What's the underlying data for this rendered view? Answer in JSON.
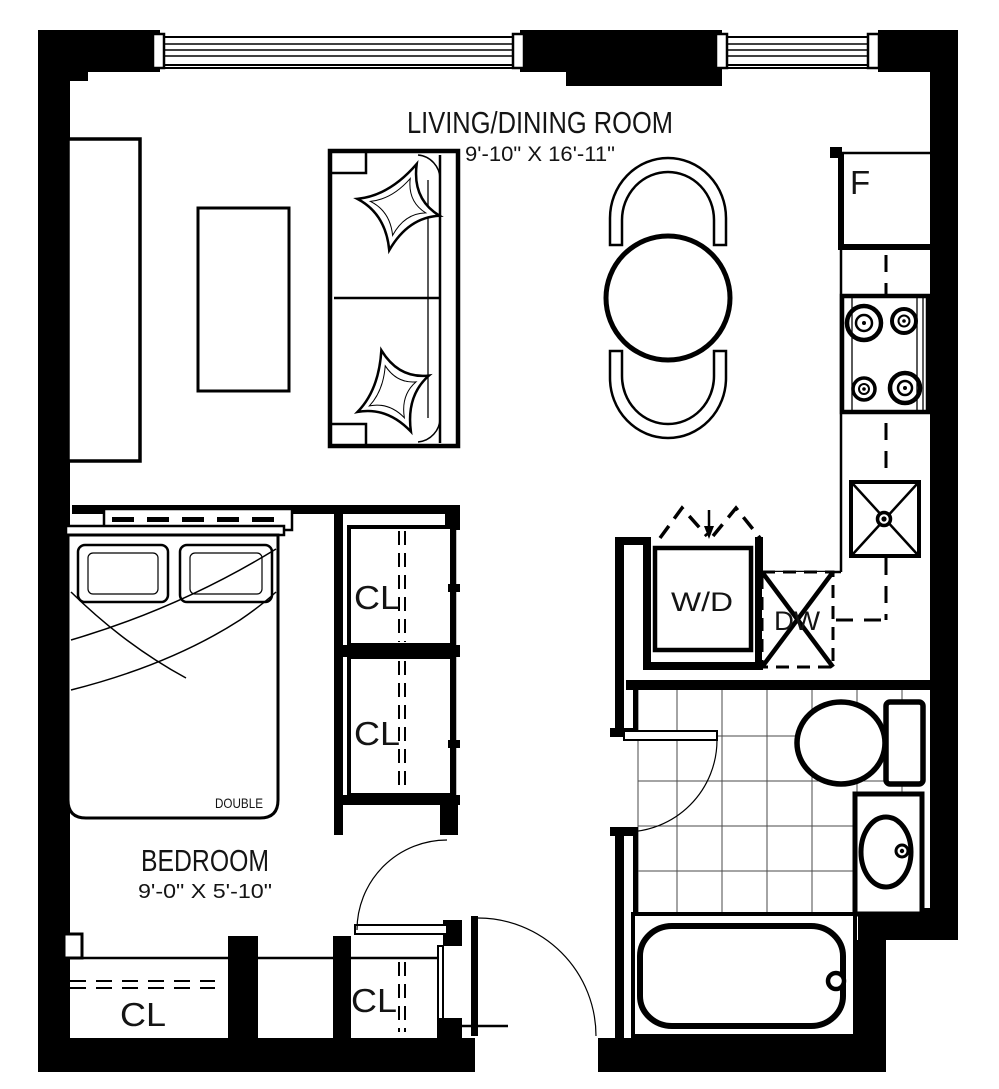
{
  "floor_plan": {
    "rooms": {
      "living_dining": {
        "name": "LIVING/DINING ROOM",
        "dimensions": "9'-10\" X 16'-11\""
      },
      "bedroom": {
        "name": "BEDROOM",
        "dimensions": "9'-0\" X 5'-10\""
      }
    },
    "labels": {
      "bed": "DOUBLE",
      "closet_upper_1": "CL",
      "closet_upper_2": "CL",
      "closet_entry_wide": "CL",
      "closet_entry_small": "CL",
      "fridge": "F",
      "washer_dryer": "W/D",
      "dishwasher": "DW"
    },
    "colors": {
      "walls": "#000000",
      "background": "#ffffff",
      "linework": "#141414",
      "tile_grid": "#4a4a4a"
    }
  }
}
